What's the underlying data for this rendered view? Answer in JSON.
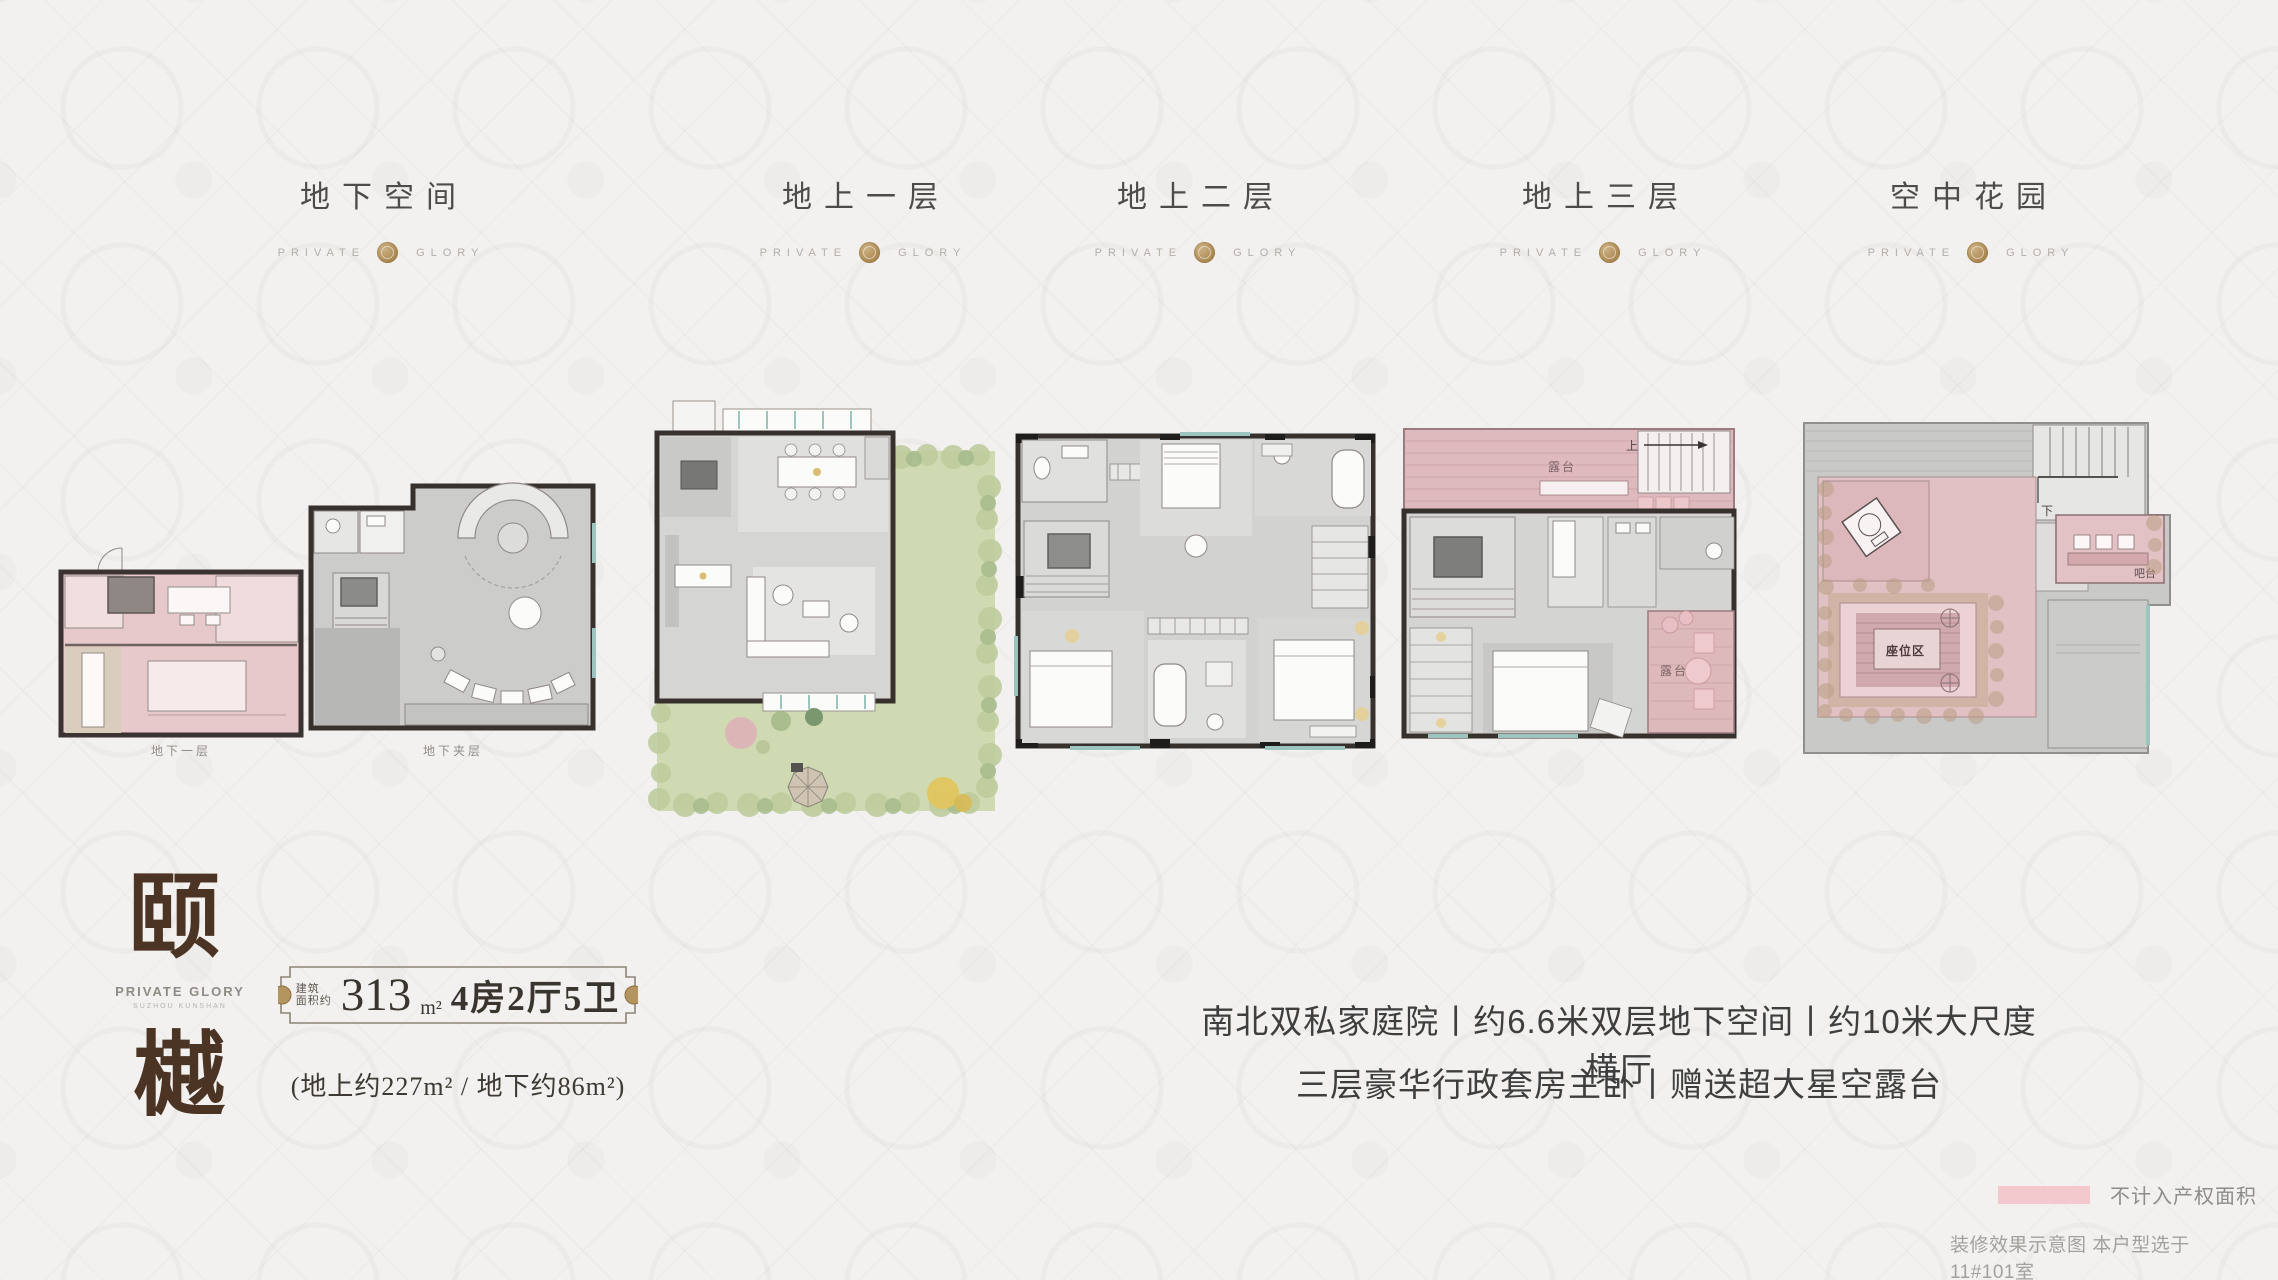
{
  "headers": [
    {
      "title": "地下空间"
    },
    {
      "title": "地上一层"
    },
    {
      "title": "地上二层"
    },
    {
      "title": "地上三层"
    },
    {
      "title": "空中花园"
    }
  ],
  "header_brand": {
    "left": "PRIVATE",
    "right": "GLORY"
  },
  "logo_block": {
    "char_top": "颐",
    "char_bottom": "樾",
    "brand": "PRIVATE GLORY",
    "sub_brand": "SUZHOU KUNSHAN"
  },
  "spec": {
    "label_top": "建筑",
    "label_bottom": "面积约",
    "area": "313",
    "unit": "m²",
    "rooms": "4房2厅5卫",
    "note": "(地上约227m² / 地下约86m²)"
  },
  "taglines": {
    "line1": "南北双私家庭院丨约6.6米双层地下空间丨约10米大尺度横厅",
    "line2": "三层豪华行政套房主卧丨赠送超大星空露台"
  },
  "legend": {
    "label": "不计入产权面积",
    "swatch_color": "#f4c9ce"
  },
  "disclaimer": "装修效果示意图 本户型选于11#101室",
  "plans": {
    "basement": {
      "caption_left": "地下一层",
      "caption_right": "地下夹层"
    },
    "floor3": {
      "terrace_top": "露台",
      "terrace_side": "露台",
      "up": "上"
    },
    "sky_garden": {
      "seating": "座位区",
      "bar": "吧台",
      "down": "下"
    }
  },
  "colors": {
    "gold_seal": "#ab8b5b",
    "plan_pink": "#e3c4c7",
    "plan_gray": "#cdcdcb",
    "garden_green": "#cfdab2",
    "wall": "#37312e"
  }
}
